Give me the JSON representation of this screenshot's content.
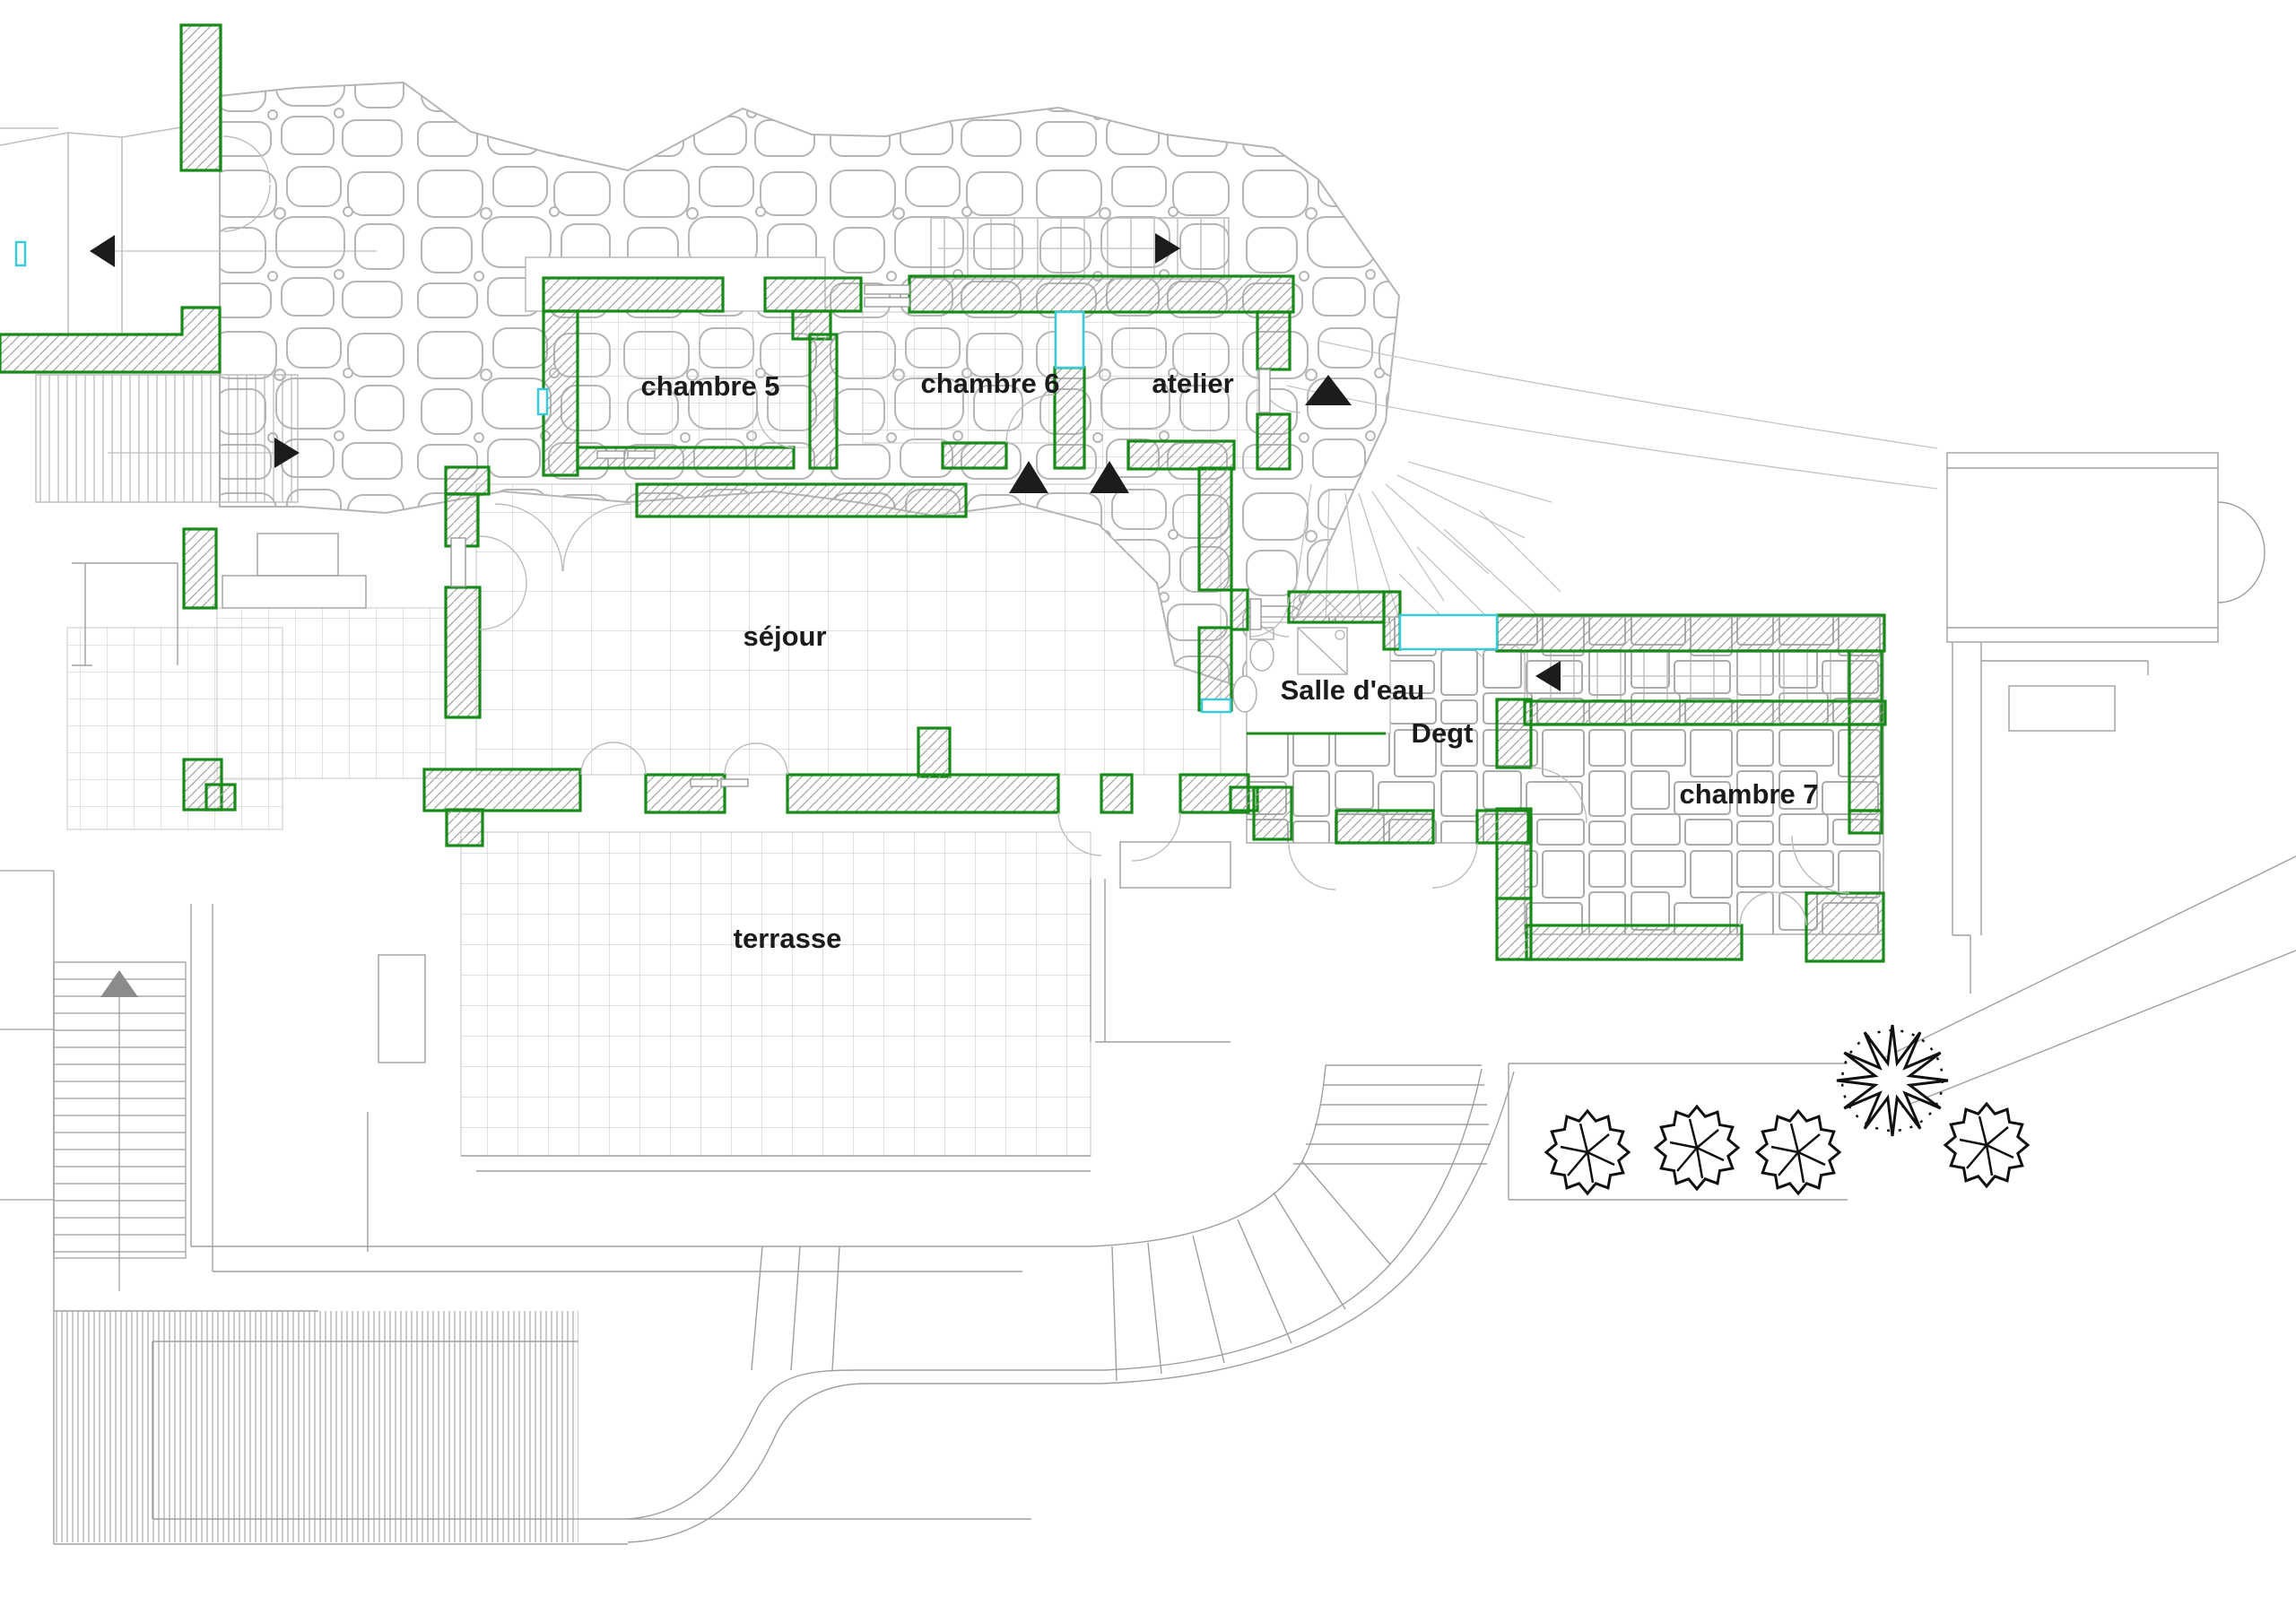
{
  "drawing": {
    "type": "architectural-floor-plan",
    "rooms": [
      {
        "id": "chambre-5",
        "label": "chambre 5"
      },
      {
        "id": "chambre-6",
        "label": "chambre 6"
      },
      {
        "id": "atelier",
        "label": "atelier"
      },
      {
        "id": "sejour",
        "label": "séjour"
      },
      {
        "id": "salle-deau",
        "label": "Salle d'eau"
      },
      {
        "id": "degt",
        "label": "Degt"
      },
      {
        "id": "chambre-7",
        "label": "chambre 7"
      },
      {
        "id": "terrasse",
        "label": "terrasse"
      }
    ],
    "colors": {
      "wall_outline_green": "#178a17",
      "window_cyan": "#3cc9dd",
      "wall_hatch_gray": "#a0a0a0",
      "stone_gray": "#b5b5b5",
      "tile_grid_gray": "#c6c6c6",
      "terrain_line_gray": "#9f9f9f",
      "arrow_black": "#1c1c1c",
      "arrow_gray": "#8b8b8b",
      "tree_black": "#101010",
      "background": "#ffffff"
    },
    "icons": {
      "direction_arrows": [
        "arrow-left-icon",
        "arrow-right-icon",
        "arrow-up-icon"
      ],
      "vegetation": [
        "shrub-icon",
        "deciduous-tree-icon"
      ],
      "fixtures": [
        "toilet-icon",
        "sink-icon",
        "shower-icon"
      ]
    }
  }
}
